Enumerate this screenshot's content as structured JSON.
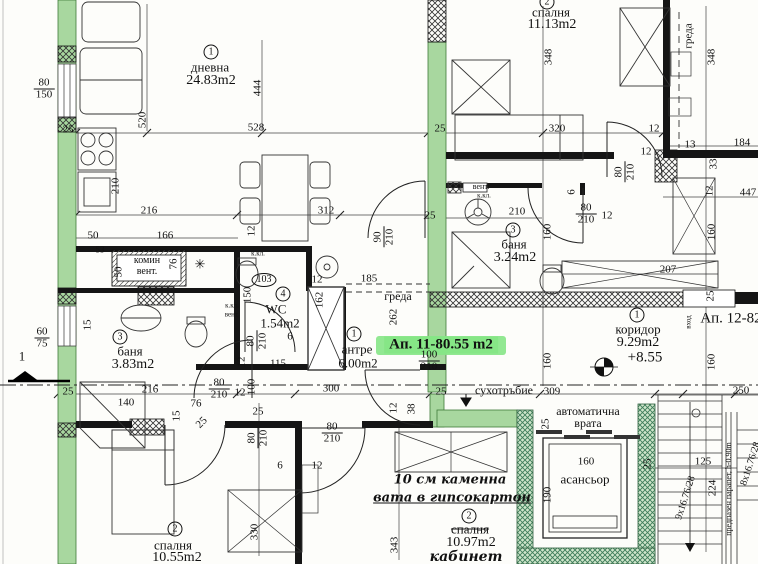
{
  "colors": {
    "wall_highlight_green": "#a8d79f",
    "marker_highlight_green": "#86e686",
    "elevator_hatch_green": "#3f7d5a",
    "line": "#1a1a1a",
    "paper": "#fdfdfa"
  },
  "room_labels": [
    {
      "n": "room-dnevna-number",
      "t": "1",
      "c": "circ",
      "x": 211,
      "y": 52
    },
    {
      "n": "room-dnevna-name",
      "t": "дневна",
      "x": 210,
      "y": 67,
      "s": 13
    },
    {
      "n": "room-dnevna-area",
      "t": "24.83m2",
      "x": 211,
      "y": 81,
      "s": 14
    },
    {
      "n": "room-spalnya-top-number",
      "t": "2",
      "c": "circ",
      "x": 547,
      "y": 2
    },
    {
      "n": "room-spalnya-top-name",
      "t": "спалня",
      "x": 551,
      "y": 12,
      "s": 13
    },
    {
      "n": "room-spalnya-top-area",
      "t": "11.13m2",
      "x": 552,
      "y": 25,
      "s": 14
    },
    {
      "n": "room-banya-left-number",
      "t": "3",
      "c": "circ",
      "x": 120,
      "y": 337
    },
    {
      "n": "room-banya-left-name",
      "t": "баня",
      "x": 130,
      "y": 351,
      "s": 13
    },
    {
      "n": "room-banya-left-area",
      "t": "3.83m2",
      "x": 133,
      "y": 365,
      "s": 14
    },
    {
      "n": "room-wc-number",
      "t": "4",
      "c": "circ",
      "x": 283,
      "y": 294
    },
    {
      "n": "room-wc-name",
      "t": "WC",
      "x": 276,
      "y": 309,
      "s": 13
    },
    {
      "n": "room-wc-area",
      "t": "1.54m2",
      "x": 280,
      "y": 323,
      "s": 13
    },
    {
      "n": "room-antre-number",
      "t": "1",
      "c": "circ",
      "x": 354,
      "y": 334
    },
    {
      "n": "room-antre-name",
      "t": "антре",
      "x": 357,
      "y": 349,
      "s": 13
    },
    {
      "n": "room-antre-area",
      "t": "6.00m2",
      "x": 358,
      "y": 363,
      "s": 13
    },
    {
      "n": "room-banya-right-number",
      "t": "3",
      "c": "circ",
      "x": 513,
      "y": 230
    },
    {
      "n": "room-banya-right-name",
      "t": "баня",
      "x": 514,
      "y": 244,
      "s": 13
    },
    {
      "n": "room-banya-right-area",
      "t": "3.24m2",
      "x": 515,
      "y": 258,
      "s": 14
    },
    {
      "n": "room-koridor-number",
      "t": "1",
      "c": "circ",
      "x": 637,
      "y": 315
    },
    {
      "n": "room-koridor-name",
      "t": "коридор",
      "x": 638,
      "y": 329,
      "s": 13
    },
    {
      "n": "room-koridor-area",
      "t": "9.29m2",
      "x": 638,
      "y": 343,
      "s": 14
    },
    {
      "n": "koridor-level-mark",
      "t": "+8.55",
      "x": 645,
      "y": 358,
      "s": 15
    },
    {
      "n": "room-spalnya-bl-number",
      "t": "2",
      "c": "circ",
      "x": 175,
      "y": 529
    },
    {
      "n": "room-spalnya-bl-name",
      "t": "спалня",
      "x": 173,
      "y": 545,
      "s": 13
    },
    {
      "n": "room-spalnya-bl-area",
      "t": "10.55m2",
      "x": 177,
      "y": 558,
      "s": 14
    },
    {
      "n": "room-spalnya-bc-number",
      "t": "2",
      "c": "circ",
      "x": 469,
      "y": 516
    },
    {
      "n": "room-spalnya-bc-name",
      "t": "спалня",
      "c": "struck",
      "x": 470,
      "y": 529,
      "s": 13
    },
    {
      "n": "room-spalnya-bc-area",
      "t": "10.97m2",
      "x": 471,
      "y": 543,
      "s": 14
    },
    {
      "n": "room-kabinet-name",
      "t": "кабинет",
      "c": "hand",
      "x": 466,
      "y": 557,
      "s": 14
    },
    {
      "n": "room-asansior-name",
      "t": "асансьор",
      "x": 585,
      "y": 479,
      "s": 13
    },
    {
      "n": "apartment-11-label",
      "t": "Ап. 11-80.55 m2",
      "c": "hl",
      "x": 441,
      "y": 345,
      "s": 15
    },
    {
      "n": "apartment-12-label",
      "t": "Ап. 12-82",
      "x": 731,
      "y": 319,
      "s": 15
    }
  ],
  "annotation_labels": [
    {
      "n": "komin-vent-line1",
      "t": "комин",
      "x": 147,
      "y": 261,
      "s": 10
    },
    {
      "n": "komin-vent-line2",
      "t": "вент.",
      "x": 147,
      "y": 272,
      "s": 10
    },
    {
      "n": "kkl-wc-label",
      "t": "к.кл.",
      "x": 258,
      "y": 254,
      "s": 7
    },
    {
      "n": "shaft-103-label",
      "t": "103",
      "c": "ell",
      "x": 264,
      "y": 280,
      "s": 10
    },
    {
      "n": "vent-right-label",
      "t": "вент.",
      "x": 481,
      "y": 187,
      "s": 8
    },
    {
      "n": "kkl-right-label",
      "t": "к.кл.",
      "x": 484,
      "y": 196,
      "s": 7
    },
    {
      "n": "kkl-banya-label",
      "t": "к.кл.",
      "x": 232,
      "y": 306,
      "s": 7
    },
    {
      "n": "vent-banya-label",
      "t": "вент.",
      "x": 232,
      "y": 315,
      "s": 7
    },
    {
      "n": "greda-top-label",
      "t": "греда",
      "x": 689,
      "y": 36,
      "s": 11,
      "r": -90
    },
    {
      "n": "greda-center-label",
      "t": "греда",
      "x": 398,
      "y": 296,
      "s": 12
    },
    {
      "n": "suhotrabie-label",
      "t": "сухотръбие",
      "x": 504,
      "y": 390,
      "s": 12
    },
    {
      "n": "avtomatichna-vrata-line1",
      "t": "автоматична",
      "x": 588,
      "y": 411,
      "s": 12
    },
    {
      "n": "avtomatichna-vrata-line2",
      "t": "врата",
      "x": 588,
      "y": 423,
      "s": 12
    },
    {
      "n": "stairs-down-label",
      "t": "9x16.76/28",
      "x": 686,
      "y": 498,
      "s": 10,
      "r": -72
    },
    {
      "n": "stairs-up-label",
      "t": "8x16.76/28",
      "x": 751,
      "y": 464,
      "s": 10,
      "r": -72
    },
    {
      "n": "parapet-label",
      "t": "предпазен парапет, h-0.90m",
      "x": 729,
      "y": 489,
      "s": 8,
      "r": -90
    },
    {
      "n": "handwritten-note-line1",
      "t": "10 см каменна",
      "c": "hand",
      "x": 450,
      "y": 480,
      "s": 13
    },
    {
      "n": "handwritten-note-line2",
      "t": "вата в гипсокартон",
      "c": "hand u",
      "x": 452,
      "y": 498,
      "s": 13
    },
    {
      "n": "vhod-label",
      "t": "вход",
      "x": 689,
      "y": 322,
      "s": 7,
      "r": -90
    },
    {
      "n": "section-mark-number",
      "t": "1",
      "x": 22,
      "y": 356,
      "s": 13
    },
    {
      "n": "snowflake-symbol",
      "t": "✳",
      "x": 200,
      "y": 264,
      "s": 13
    }
  ],
  "dimension_labels": [
    {
      "t": "80/150",
      "c": "frac",
      "x": 44,
      "y": 89
    },
    {
      "t": "25",
      "x": 68,
      "y": 130
    },
    {
      "t": "520",
      "x": 143,
      "y": 120,
      "r": -90
    },
    {
      "t": "210",
      "x": 116,
      "y": 186,
      "r": -90
    },
    {
      "t": "528",
      "x": 256,
      "y": 128
    },
    {
      "t": "444",
      "x": 258,
      "y": 88,
      "r": -90
    },
    {
      "t": "216",
      "x": 149,
      "y": 211
    },
    {
      "t": "312",
      "x": 326,
      "y": 211
    },
    {
      "t": "50",
      "x": 93,
      "y": 236
    },
    {
      "t": "166",
      "x": 165,
      "y": 236
    },
    {
      "t": "53",
      "x": 100,
      "y": 250,
      "s": 9
    },
    {
      "t": "50",
      "x": 119,
      "y": 272,
      "r": -90
    },
    {
      "t": "76",
      "x": 174,
      "y": 264,
      "r": -90
    },
    {
      "t": "15",
      "x": 88,
      "y": 325,
      "r": -90
    },
    {
      "t": "60/75",
      "c": "frac",
      "x": 42,
      "y": 338
    },
    {
      "t": "25",
      "x": 68,
      "y": 392
    },
    {
      "t": "140",
      "x": 126,
      "y": 403
    },
    {
      "t": "216",
      "x": 150,
      "y": 390
    },
    {
      "t": "76",
      "x": 196,
      "y": 404
    },
    {
      "t": "80/210",
      "c": "frac",
      "x": 219,
      "y": 389
    },
    {
      "t": "12",
      "x": 240,
      "y": 393
    },
    {
      "t": "100",
      "x": 252,
      "y": 387,
      "r": -90
    },
    {
      "t": "25",
      "x": 258,
      "y": 412
    },
    {
      "t": "15",
      "x": 177,
      "y": 416,
      "r": -90
    },
    {
      "t": "25",
      "x": 202,
      "y": 423,
      "r": -45
    },
    {
      "t": "80/210",
      "c": "frac",
      "x": 258,
      "y": 438,
      "r": -90
    },
    {
      "t": "6",
      "x": 280,
      "y": 466
    },
    {
      "t": "12",
      "x": 317,
      "y": 466
    },
    {
      "t": "80/210",
      "c": "frac",
      "x": 332,
      "y": 433
    },
    {
      "t": "330",
      "x": 255,
      "y": 532,
      "r": -90
    },
    {
      "t": "343",
      "x": 395,
      "y": 545,
      "r": -90
    },
    {
      "t": "12",
      "x": 394,
      "y": 408,
      "r": -90
    },
    {
      "t": "38",
      "x": 412,
      "y": 409,
      "r": -90
    },
    {
      "t": "300",
      "x": 331,
      "y": 389
    },
    {
      "t": "150",
      "x": 248,
      "y": 295,
      "r": -90
    },
    {
      "t": "80/210",
      "c": "frac",
      "x": 257,
      "y": 341,
      "r": -90
    },
    {
      "t": "6",
      "x": 290,
      "y": 337
    },
    {
      "t": "12",
      "x": 242,
      "y": 362,
      "r": -90
    },
    {
      "t": "115",
      "x": 278,
      "y": 364
    },
    {
      "t": "162",
      "x": 320,
      "y": 300,
      "r": -90
    },
    {
      "t": "12",
      "x": 317,
      "y": 280
    },
    {
      "t": "185",
      "x": 369,
      "y": 279
    },
    {
      "t": "262",
      "x": 394,
      "y": 317,
      "r": -90
    },
    {
      "t": "90/210",
      "c": "frac",
      "x": 384,
      "y": 237,
      "r": -90
    },
    {
      "t": "12",
      "x": 252,
      "y": 231,
      "r": -90
    },
    {
      "t": "25",
      "x": 430,
      "y": 216
    },
    {
      "t": "100/210",
      "c": "frac",
      "x": 429,
      "y": 361
    },
    {
      "t": "25",
      "x": 440,
      "y": 129
    },
    {
      "t": "348",
      "x": 549,
      "y": 57,
      "r": -90
    },
    {
      "t": "348",
      "x": 712,
      "y": 57,
      "r": -90
    },
    {
      "t": "320",
      "x": 557,
      "y": 129
    },
    {
      "t": "12",
      "x": 654,
      "y": 129
    },
    {
      "t": "12",
      "x": 646,
      "y": 152
    },
    {
      "t": "80/210",
      "c": "frac",
      "x": 625,
      "y": 172,
      "r": -90
    },
    {
      "t": "13",
      "x": 690,
      "y": 145
    },
    {
      "t": "184",
      "x": 742,
      "y": 143
    },
    {
      "t": "33",
      "x": 714,
      "y": 164,
      "r": -90
    },
    {
      "t": "12",
      "x": 710,
      "y": 191,
      "r": -90
    },
    {
      "t": "447",
      "x": 748,
      "y": 193
    },
    {
      "t": "6",
      "x": 572,
      "y": 192,
      "r": -90
    },
    {
      "t": "210",
      "x": 517,
      "y": 212
    },
    {
      "t": "80/210",
      "c": "frac",
      "x": 586,
      "y": 214
    },
    {
      "t": "12",
      "x": 607,
      "y": 216
    },
    {
      "t": "160",
      "x": 548,
      "y": 232,
      "r": -90
    },
    {
      "t": "160",
      "x": 712,
      "y": 232,
      "r": -90
    },
    {
      "t": "207",
      "x": 668,
      "y": 270
    },
    {
      "t": "25",
      "x": 711,
      "y": 296,
      "r": -90
    },
    {
      "t": "160",
      "x": 548,
      "y": 361,
      "r": -90
    },
    {
      "t": "160",
      "x": 712,
      "y": 362,
      "r": -90
    },
    {
      "t": "25",
      "x": 441,
      "y": 392
    },
    {
      "t": "309",
      "x": 552,
      "y": 392
    },
    {
      "t": "250",
      "x": 741,
      "y": 391
    },
    {
      "t": "25",
      "x": 546,
      "y": 424,
      "r": -90
    },
    {
      "t": "160",
      "x": 586,
      "y": 462
    },
    {
      "t": "190",
      "x": 548,
      "y": 495,
      "r": -90
    },
    {
      "t": "25",
      "x": 648,
      "y": 464,
      "r": -90
    },
    {
      "t": "125",
      "x": 703,
      "y": 462
    },
    {
      "t": "224",
      "x": 713,
      "y": 488,
      "r": -90
    }
  ]
}
